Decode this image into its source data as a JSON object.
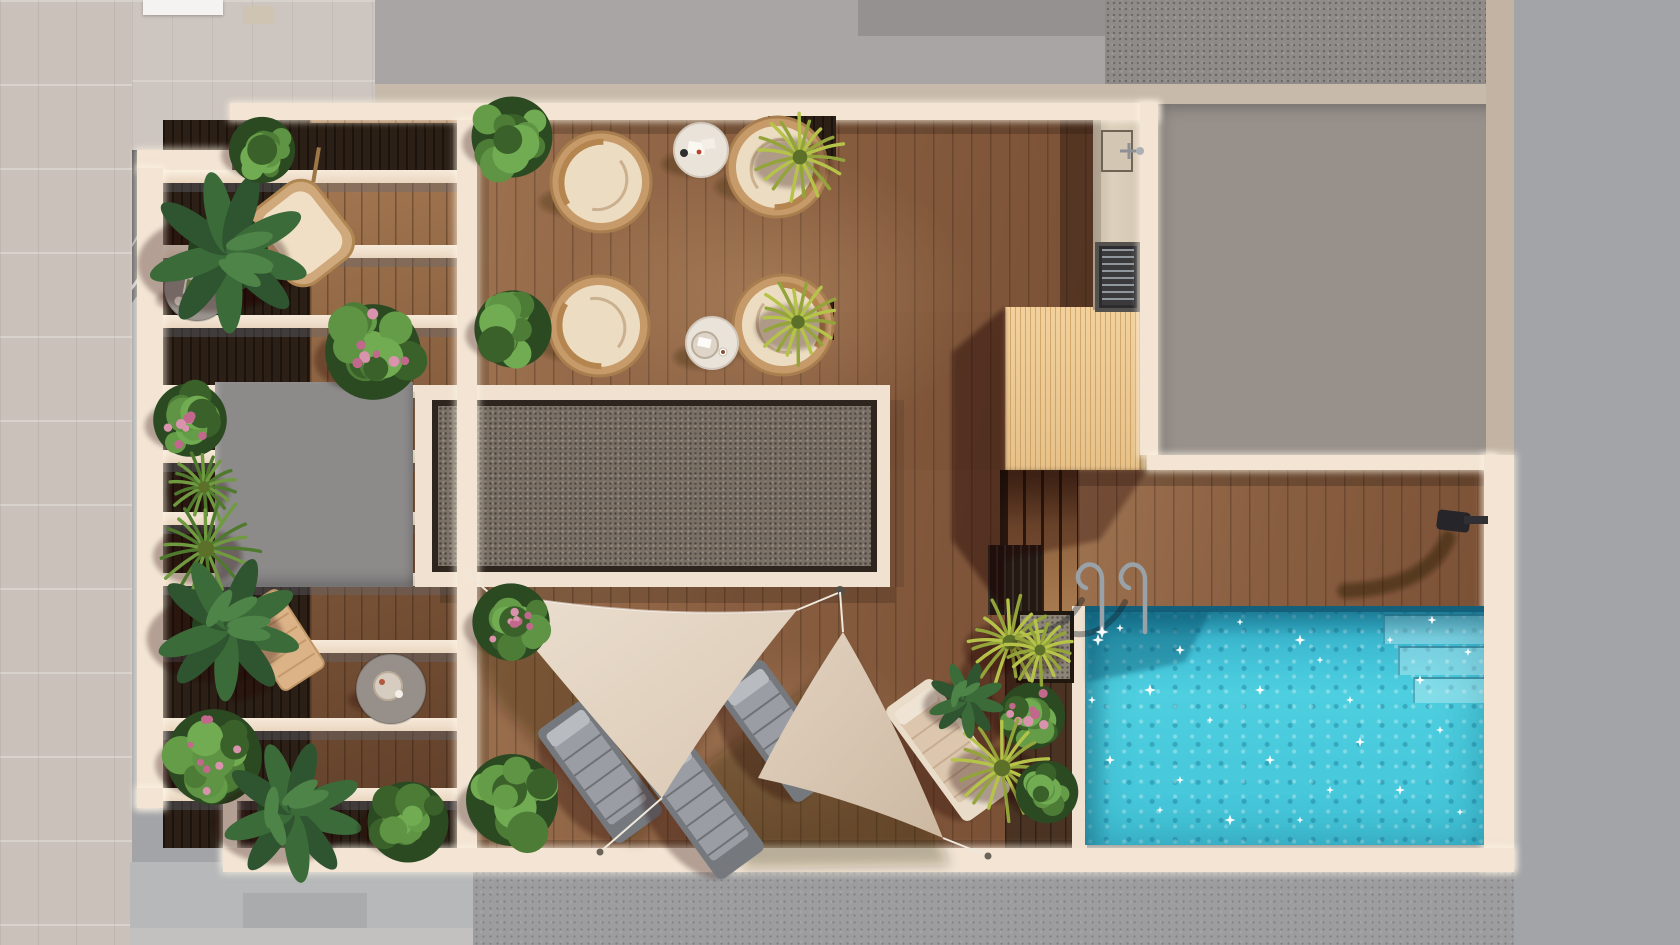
{
  "meta": {
    "description": "Aerial top-down 3D architectural rendering of a rooftop terrace with swimming pool",
    "view": "top-down plan render",
    "visible_text": ""
  },
  "palette": {
    "cream": "#f3e4d3",
    "wood": "#8a5f41",
    "woodDark": "#4a3322",
    "planter": "#2c1f15",
    "pool": "#45c6da",
    "poolDeep": "#1f97b4",
    "poolStep": "#7fdde8",
    "platform": "#ecc893",
    "gravel": "#7b7066",
    "block": "#8d8b8a",
    "roof": "#a8a5a4",
    "roofTextured": "#8f8b88",
    "courtyard": "#97908b",
    "courtyardLight": "#a89e97",
    "ground": "#9d9da0",
    "sidewalk": "#c9c1ba",
    "sail": "#e6d8c7",
    "sailDark": "#d5c2ad",
    "green": "#5f9444",
    "greenDark": "#2f5430",
    "yellowGreen": "#b5c349",
    "flowerPink": "#d993ad",
    "parapet": "#c7baaa",
    "grayRight": "#a3a4a8",
    "rattan": "#c79a6a",
    "cushion": "#ecdcc2",
    "loungerGray": "#9a9da3",
    "loungerTan": "#d9c3ab",
    "tableGray": "#9b948e",
    "water_sparkle": "#ffffff"
  },
  "scene": {
    "areas": [
      "street-sidewalk-left",
      "neighbor-roof-top",
      "neighbor-roof-textured",
      "courtyard-right",
      "pergola-wing-left",
      "main-wood-deck",
      "gravel-skylight",
      "elevator-block",
      "outdoor-kitchen",
      "sauna-platform",
      "deck-stairs",
      "pool-terrace",
      "swimming-pool",
      "street-bottom"
    ],
    "objects": {
      "shade-sails": 2,
      "wicker-chairs": 4,
      "bistro-tables": 2,
      "side-tables": 2,
      "sun-loungers": 4,
      "hanging-chair": 1,
      "wooden-bench": 1,
      "pool-ladder": 1,
      "outdoor-shower": 1,
      "bbq-grill": 1,
      "kitchen-sink": 1,
      "pergola-beams": 10,
      "stair-treads": 4,
      "pool-steps": 3,
      "plants": 24
    }
  }
}
